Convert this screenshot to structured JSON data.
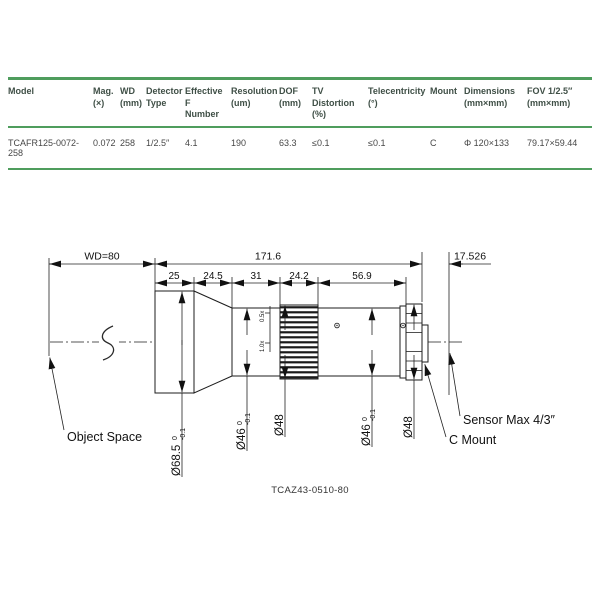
{
  "table": {
    "columns": [
      {
        "line1": "Model",
        "line2": ""
      },
      {
        "line1": "Mag.",
        "line2": "(×)"
      },
      {
        "line1": "WD",
        "line2": "(mm)"
      },
      {
        "line1": "Detector",
        "line2": "Type"
      },
      {
        "line1": "Effective F",
        "line2": "Number"
      },
      {
        "line1": "Resolution",
        "line2": "(um)"
      },
      {
        "line1": "DOF",
        "line2": "(mm)"
      },
      {
        "line1": "TV Distortion",
        "line2": "(%)"
      },
      {
        "line1": "Telecentricity",
        "line2": "(°)"
      },
      {
        "line1": "Mount",
        "line2": ""
      },
      {
        "line1": "Dimensions",
        "line2": "(mm×mm)"
      },
      {
        "line1": "FOV 1/2.5″",
        "line2": "(mm×mm)"
      }
    ],
    "row": [
      "TCAFR125-0072-258",
      "0.072",
      "258",
      "1/2.5″",
      "4.1",
      "190",
      "63.3",
      "≤0.1",
      "≤0.1",
      "C",
      "Φ 120×133",
      "79.17×59.44"
    ]
  },
  "drawing": {
    "dims": {
      "wd": "WD=80",
      "total": "171.6",
      "flange": "17.526",
      "seg0": "25",
      "seg1": "24.5",
      "seg2": "31",
      "seg3": "24.2",
      "seg4": "56.9"
    },
    "diameters": {
      "front": {
        "value": "Ø68.5",
        "tol_top": "0",
        "tol_bot": "-0.1"
      },
      "d46a": {
        "value": "Ø46",
        "tol_top": "0",
        "tol_bot": "-0.1"
      },
      "d48a": {
        "value": "Ø48"
      },
      "d46b": {
        "value": "Ø46",
        "tol_top": "0",
        "tol_bot": "-0.1"
      },
      "d48b": {
        "value": "Ø48"
      }
    },
    "scale_marks": {
      "top": "0.5x",
      "bottom": "1.0x"
    },
    "labels": {
      "object_space": "Object Space",
      "c_mount": "C Mount",
      "sensor": "Sensor Max 4/3″"
    },
    "caption": "TCAZ43-0510-80"
  }
}
